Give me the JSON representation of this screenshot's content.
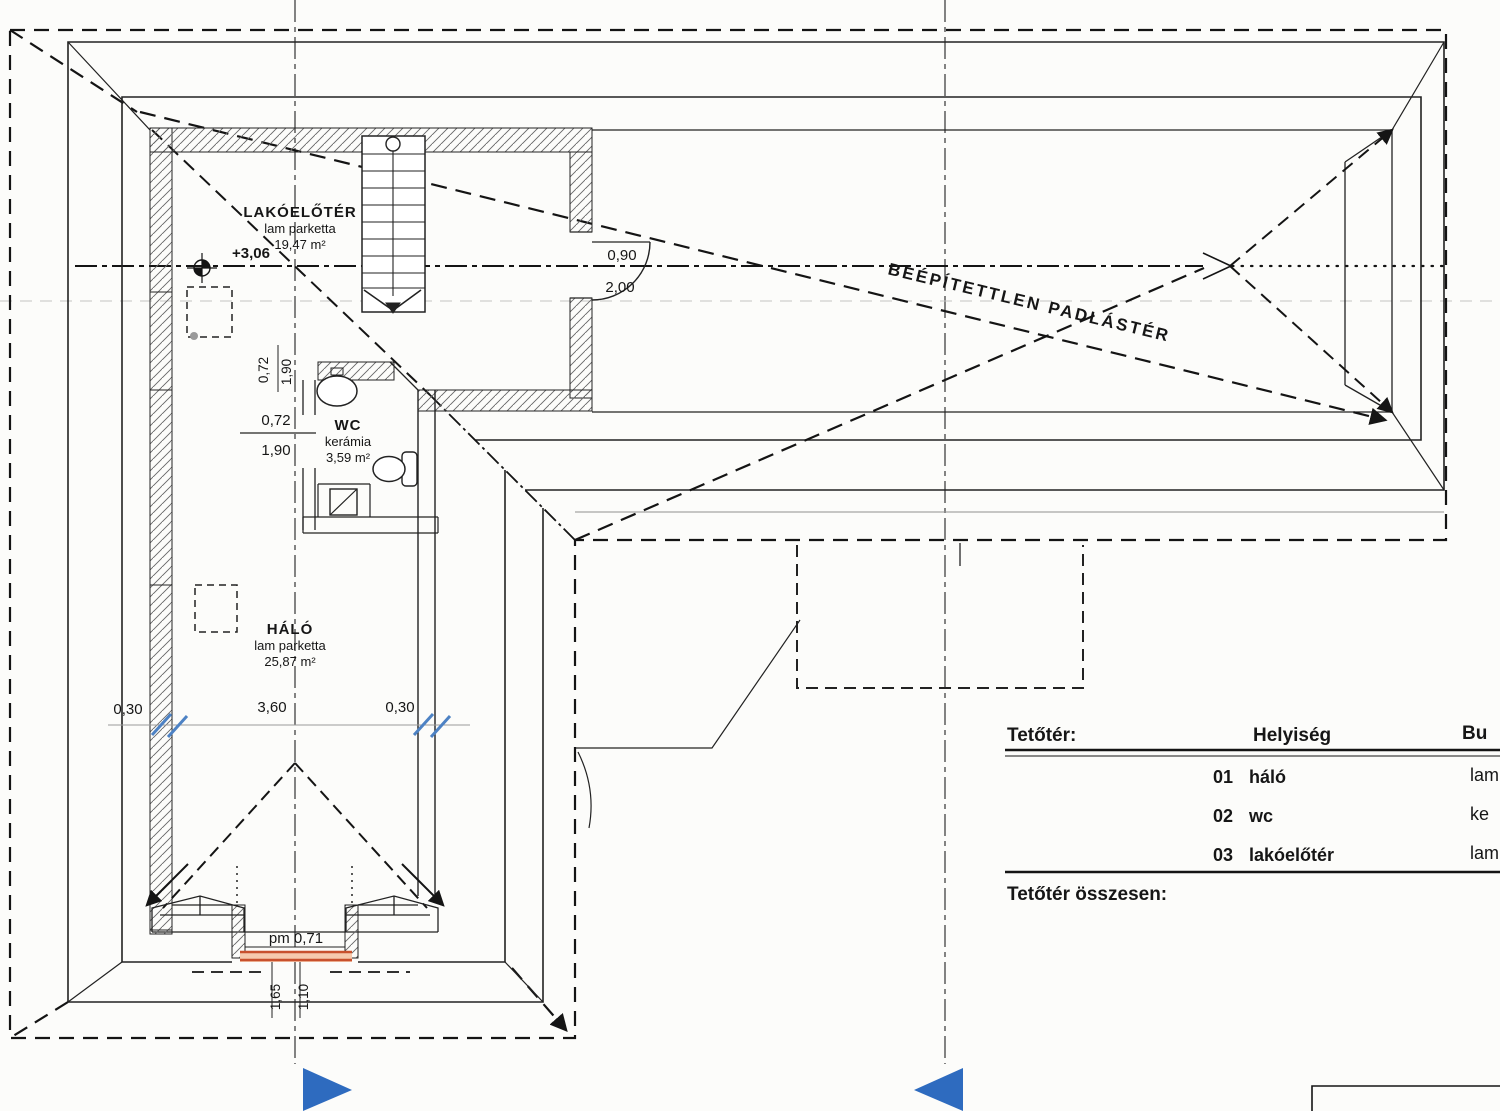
{
  "plan": {
    "rooms": {
      "lakoeloter": {
        "name": "LAKÓELŐTÉR",
        "floor": "lam parketta",
        "area": "19,47 m²"
      },
      "wc": {
        "name": "WC",
        "floor": "kerámia",
        "area": "3,59 m²"
      },
      "halo": {
        "name": "HÁLÓ",
        "floor": "lam parketta",
        "area": "25,87 m²"
      }
    },
    "labels": {
      "attic": "BEÉPÍTETTLEN PADLÁSTÉR",
      "level": "+3,06",
      "door_width": "0,90",
      "door_height": "2,00",
      "parapet": "pm 0,71"
    },
    "dimensions": {
      "wall_left": "0,30",
      "room_width": "3,60",
      "wall_right": "0,30",
      "wc_width": "0,72",
      "wc_depth": "1,90",
      "sill_a": "1,65",
      "sill_b": "1,10"
    },
    "colors": {
      "highlight": "#c8502d",
      "section_arrow": "#2e6bbf",
      "tick_blue": "#4d82c4"
    }
  },
  "table": {
    "title": "Tetőtér:",
    "col_room": "Helyiség",
    "col_finish": "Bu",
    "rows": [
      {
        "no": "01",
        "name": "háló",
        "finish": "lam"
      },
      {
        "no": "02",
        "name": "wc",
        "finish": "ke"
      },
      {
        "no": "03",
        "name": "lakóelőtér",
        "finish": "lam"
      }
    ],
    "total_label": "Tetőtér összesen:"
  }
}
